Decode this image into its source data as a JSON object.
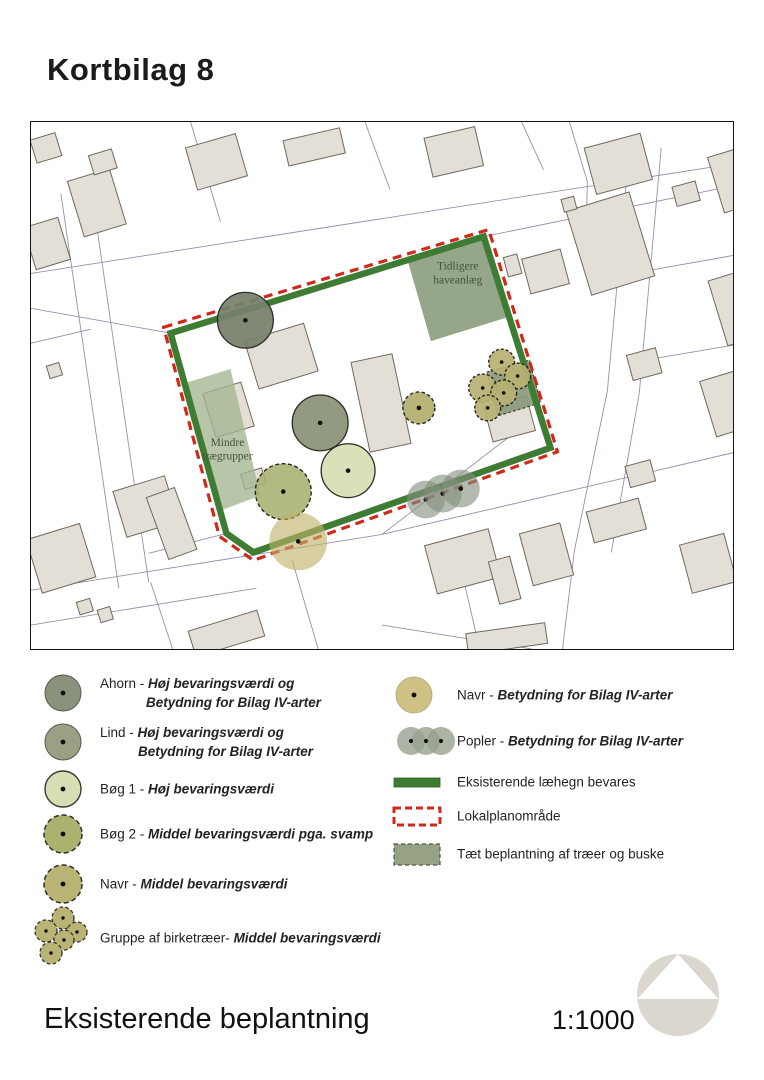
{
  "page": {
    "title": "Kortbilag 8",
    "footer_title": "Eksisterende beplantning",
    "scale_label": "1:1000"
  },
  "map": {
    "style": {
      "parcel": "#9c8dac",
      "building_fill": "#e4dfd6",
      "building_stroke": "#6f685e",
      "hedge": "#3e7b33",
      "boundary": "#d0281a",
      "tree_stroke": "#2d2d27",
      "tree_stroke_dashed": "#26261f",
      "label": "#44523b"
    },
    "parcel_lines": [
      [
        [
          0,
          152
        ],
        [
          704,
          42
        ]
      ],
      [
        [
          0,
          187
        ],
        [
          140,
          212
        ]
      ],
      [
        [
          454,
          115
        ],
        [
          704,
          64
        ]
      ],
      [
        [
          600,
          28
        ],
        [
          578,
          270
        ]
      ],
      [
        [
          632,
          26
        ],
        [
          610,
          272
        ]
      ],
      [
        [
          578,
          270
        ],
        [
          545,
          430
        ],
        [
          533,
          529
        ]
      ],
      [
        [
          610,
          272
        ],
        [
          582,
          432
        ]
      ],
      [
        [
          0,
          470
        ],
        [
          352,
          414
        ],
        [
          704,
          332
        ]
      ],
      [
        [
          0,
          505
        ],
        [
          226,
          468
        ]
      ],
      [
        [
          352,
          505
        ],
        [
          502,
          529
        ]
      ],
      [
        [
          60,
          64
        ],
        [
          118,
          462
        ]
      ],
      [
        [
          30,
          72
        ],
        [
          88,
          468
        ]
      ],
      [
        [
          160,
          0
        ],
        [
          190,
          100
        ]
      ],
      [
        [
          335,
          0
        ],
        [
          360,
          68
        ]
      ],
      [
        [
          492,
          0
        ],
        [
          514,
          48
        ]
      ],
      [
        [
          614,
          150
        ],
        [
          704,
          134
        ]
      ],
      [
        [
          598,
          242
        ],
        [
          704,
          224
        ]
      ],
      [
        [
          352,
          414
        ],
        [
          490,
          308
        ]
      ],
      [
        [
          120,
          462
        ],
        [
          142,
          529
        ]
      ],
      [
        [
          262,
          440
        ],
        [
          288,
          529
        ]
      ],
      [
        [
          425,
          422
        ],
        [
          450,
          529
        ]
      ],
      [
        [
          196,
          413
        ],
        [
          118,
          433
        ]
      ],
      [
        [
          540,
          0
        ],
        [
          558,
          60
        ],
        [
          556,
          140
        ]
      ],
      [
        [
          0,
          222
        ],
        [
          60,
          208
        ]
      ]
    ],
    "buildings": [
      [
        2,
        14,
        26,
        24,
        -17
      ],
      [
        44,
        52,
        44,
        58,
        -17
      ],
      [
        60,
        30,
        24,
        20,
        -17
      ],
      [
        -2,
        100,
        36,
        44,
        -17
      ],
      [
        160,
        18,
        52,
        44,
        -16
      ],
      [
        255,
        12,
        58,
        26,
        -13
      ],
      [
        398,
        10,
        52,
        40,
        -13
      ],
      [
        560,
        18,
        58,
        48,
        -15
      ],
      [
        645,
        62,
        24,
        20,
        -15
      ],
      [
        548,
        78,
        66,
        88,
        -17
      ],
      [
        686,
        28,
        44,
        58,
        -17
      ],
      [
        688,
        152,
        42,
        68,
        -17
      ],
      [
        476,
        134,
        14,
        20,
        -15
      ],
      [
        496,
        132,
        40,
        36,
        -15
      ],
      [
        600,
        230,
        30,
        26,
        -15
      ],
      [
        678,
        252,
        50,
        58,
        -17
      ],
      [
        533,
        76,
        13,
        13,
        -15
      ],
      [
        220,
        210,
        62,
        50,
        -17
      ],
      [
        178,
        266,
        40,
        46,
        -17
      ],
      [
        212,
        350,
        22,
        16,
        -17
      ],
      [
        330,
        236,
        42,
        92,
        -12
      ],
      [
        458,
        280,
        44,
        36,
        -15
      ],
      [
        88,
        362,
        54,
        48,
        -17
      ],
      [
        2,
        410,
        56,
        56,
        -17
      ],
      [
        126,
        370,
        30,
        66,
        -20
      ],
      [
        47,
        480,
        14,
        13,
        -17
      ],
      [
        68,
        488,
        13,
        13,
        -17
      ],
      [
        400,
        416,
        66,
        50,
        -15
      ],
      [
        464,
        438,
        22,
        44,
        -15
      ],
      [
        496,
        407,
        42,
        54,
        -15
      ],
      [
        560,
        384,
        54,
        32,
        -15
      ],
      [
        598,
        342,
        26,
        22,
        -15
      ],
      [
        656,
        418,
        46,
        50,
        -15
      ],
      [
        160,
        500,
        72,
        27,
        -17
      ],
      [
        437,
        508,
        80,
        21,
        -8
      ],
      [
        17,
        243,
        13,
        13,
        -17
      ]
    ],
    "areas": [
      {
        "name": "area-tidligere-haveanlaeg",
        "points": [
          [
            378,
            140
          ],
          [
            455,
            116
          ],
          [
            478,
            196
          ],
          [
            401,
            220
          ]
        ],
        "fill": "#90a183",
        "opacity": 0.95
      },
      {
        "name": "area-mindre-traegrupper",
        "points": [
          [
            155,
            262
          ],
          [
            200,
            248
          ],
          [
            230,
            375
          ],
          [
            190,
            390
          ]
        ],
        "fill": "#a3b591",
        "opacity": 0.78
      },
      {
        "name": "area-taet-beplantning",
        "points": [
          [
            457,
            251
          ],
          [
            500,
            239
          ],
          [
            511,
            282
          ],
          [
            468,
            295
          ]
        ],
        "fill": "#8b997b",
        "opacity": 0.92,
        "stroke": "#3c3c32",
        "dash": "3 2"
      }
    ],
    "hedge": [
      [
        140,
        212
      ],
      [
        454,
        115
      ],
      [
        521,
        327
      ],
      [
        223,
        432
      ],
      [
        196,
        413
      ]
    ],
    "boundary": [
      [
        133,
        206
      ],
      [
        459,
        108
      ],
      [
        528,
        331
      ],
      [
        223,
        440
      ],
      [
        189,
        416
      ]
    ],
    "trees": [
      {
        "type": "ahorn",
        "cx": 215,
        "cy": 199,
        "r": 28,
        "fill": "#75806b",
        "op": 0.93
      },
      {
        "type": "lind",
        "cx": 290,
        "cy": 302,
        "r": 28,
        "fill": "#8b9278",
        "op": 0.93
      },
      {
        "type": "boeg1",
        "cx": 318,
        "cy": 350,
        "r": 27,
        "fill": "#d9dfb5",
        "op": 0.96
      },
      {
        "type": "boeg2",
        "cx": 253,
        "cy": 371,
        "r": 28,
        "fill": "#a8b06f",
        "op": 0.88,
        "dash": "4 2.5"
      },
      {
        "type": "navr",
        "cx": 389,
        "cy": 287,
        "r": 16,
        "fill": "#b3ae6d",
        "op": 0.92,
        "dash": "3.5 2.5"
      },
      {
        "type": "navr-bilag-iv",
        "cx": 268,
        "cy": 421,
        "r": 29,
        "fill": "#bfb169",
        "op": 0.62,
        "nostroke": true
      },
      {
        "type": "birk",
        "cx": 472,
        "cy": 241,
        "r": 13,
        "fill": "#b7b173",
        "op": 0.92,
        "dash": "3 2"
      },
      {
        "type": "birk",
        "cx": 488,
        "cy": 255,
        "r": 13,
        "fill": "#b7b173",
        "op": 0.92,
        "dash": "3 2"
      },
      {
        "type": "birk",
        "cx": 453,
        "cy": 267,
        "r": 14,
        "fill": "#b7b173",
        "op": 0.92,
        "dash": "3 2"
      },
      {
        "type": "birk",
        "cx": 474,
        "cy": 272,
        "r": 13,
        "fill": "#b7b173",
        "op": 0.92,
        "dash": "3 2"
      },
      {
        "type": "birk",
        "cx": 458,
        "cy": 287,
        "r": 13,
        "fill": "#b7b173",
        "op": 0.92,
        "dash": "3 2"
      },
      {
        "type": "popler",
        "cx": 396,
        "cy": 379,
        "r": 19,
        "fill": "#85907e",
        "op": 0.62,
        "nostroke": true
      },
      {
        "type": "popler",
        "cx": 413,
        "cy": 373,
        "r": 19,
        "fill": "#85907e",
        "op": 0.62,
        "nostroke": true
      },
      {
        "type": "popler",
        "cx": 431,
        "cy": 368,
        "r": 19,
        "fill": "#85907e",
        "op": 0.62,
        "nostroke": true
      }
    ],
    "labels": [
      {
        "lines": [
          "Tidligere",
          "haveanlæg"
        ],
        "x": 428,
        "y": 148,
        "size": 11.5
      },
      {
        "lines": [
          "Mindre",
          "trægrupper"
        ],
        "x": 197,
        "y": 325,
        "size": 11.5
      }
    ]
  },
  "legend": {
    "columns": [
      {
        "id": "left",
        "sx": 63,
        "lx": 100,
        "items": [
          {
            "label": "Ahorn",
            "sep": " - ",
            "desc": [
              "Høj bevaringsværdi og",
              "Betydning for Bilag IV-arter"
            ],
            "indent": 46,
            "y": 693,
            "symbol": {
              "kind": "circle",
              "r": 18,
              "fill": "#8b927b",
              "stroke": "#565a4d",
              "sw": 1
            }
          },
          {
            "label": "Lind",
            "sep": " - ",
            "desc": [
              "Høj bevaringsværdi og",
              "Betydning for Bilag IV-arter"
            ],
            "indent": 38,
            "y": 742,
            "symbol": {
              "kind": "circle",
              "r": 18,
              "fill": "#9aa084",
              "stroke": "#565a4d",
              "sw": 1
            }
          },
          {
            "label": "Bøg 1",
            "sep": " - ",
            "desc": [
              "Høj bevaringsværdi"
            ],
            "y": 789,
            "symbol": {
              "kind": "circle",
              "r": 18,
              "fill": "#d8deb4",
              "stroke": "#3a3a31",
              "sw": 1.4
            }
          },
          {
            "label": "Bøg 2",
            "sep": " - ",
            "desc": [
              "Middel bevaringsværdi pga. svamp"
            ],
            "y": 834,
            "symbol": {
              "kind": "circle",
              "r": 19,
              "fill": "#abb26f",
              "stroke": "#2e2e26",
              "sw": 1.5,
              "dash": "5 3"
            }
          },
          {
            "label": "Navr",
            "sep": " - ",
            "desc": [
              "Middel bevaringsværdi"
            ],
            "y": 884,
            "symbol": {
              "kind": "circle",
              "r": 19,
              "fill": "#b9b475",
              "stroke": "#2e2e26",
              "sw": 1.5,
              "dash": "5 3"
            }
          },
          {
            "label": "Gruppe af birketræer",
            "sep": "- ",
            "desc": [
              "Middel bevaringsværdi"
            ],
            "y": 938,
            "symbol": {
              "kind": "cluster",
              "fill": "#b9b475",
              "stroke": "#33332c",
              "sw": 1.3,
              "dash": "3.5 2.5",
              "circles": [
                [
                  0,
                  -24,
                  11
                ],
                [
                  14,
                  -10,
                  10
                ],
                [
                  -17,
                  -11,
                  11
                ],
                [
                  1,
                  -2,
                  10
                ],
                [
                  -12,
                  11,
                  11
                ]
              ]
            }
          }
        ]
      },
      {
        "id": "right",
        "sx": 417,
        "lx": 457,
        "items": [
          {
            "label": "Navr",
            "sep": " - ",
            "desc": [
              "Betydning for Bilag IV-arter"
            ],
            "y": 695,
            "sx": 414,
            "symbol": {
              "kind": "circle",
              "r": 18,
              "fill": "#cfc083",
              "stroke": "#b0a671",
              "sw": 0.8
            }
          },
          {
            "label": "Popler",
            "sep": " - ",
            "desc": [
              "Betydning for Bilag IV-arter"
            ],
            "y": 741,
            "sx": 426,
            "symbol": {
              "kind": "poplar",
              "r": 14,
              "fill": "#97a18f",
              "centers": [
                [
                  -15,
                  0
                ],
                [
                  0,
                  0
                ],
                [
                  15,
                  0
                ]
              ]
            }
          },
          {
            "label": "Eksisterende læhegn bevares",
            "sep": "",
            "desc": [],
            "y": 782,
            "symbol": {
              "kind": "bar",
              "w": 46,
              "h": 9,
              "fill": "#3e7b33",
              "stroke": "#2c5a24",
              "sw": 0.8
            }
          },
          {
            "label": "Lokalplanområde",
            "sep": "",
            "desc": [],
            "y": 816,
            "symbol": {
              "kind": "rect",
              "w": 46,
              "h": 17,
              "fill": "none",
              "stroke": "#d0281a",
              "sw": 3,
              "dash": "7 4"
            }
          },
          {
            "label": "Tæt beplantning af træer og buske",
            "sep": "",
            "desc": [],
            "y": 854,
            "symbol": {
              "kind": "rect",
              "w": 46,
              "h": 21,
              "fill": "#97a285",
              "stroke": "#50554a",
              "sw": 1.2,
              "dash": "4 3"
            }
          }
        ]
      }
    ]
  },
  "logo": {
    "circle_fill": "#dcd7ce",
    "triangle_fill": "#ffffff"
  }
}
